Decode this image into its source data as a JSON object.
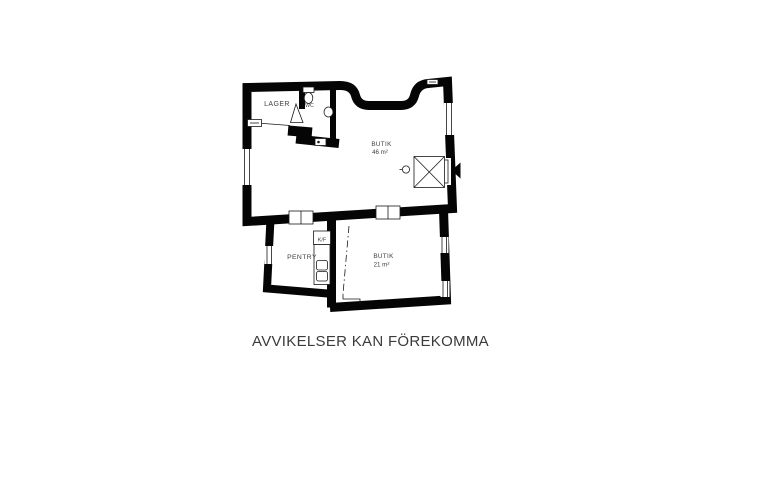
{
  "floorplan": {
    "rooms": [
      {
        "label": "LAGER"
      },
      {
        "label": "WC"
      },
      {
        "label": "BUTIK",
        "area": "46 m²"
      },
      {
        "label": "PENTRY"
      },
      {
        "label": "K/F"
      },
      {
        "label": "BUTIK",
        "area": "21 m²"
      }
    ],
    "colors": {
      "wall": "#050505",
      "label": "#3f3f3f"
    }
  },
  "footer": {
    "disclaimer": "AVVIKELSER KAN FÖREKOMMA"
  }
}
